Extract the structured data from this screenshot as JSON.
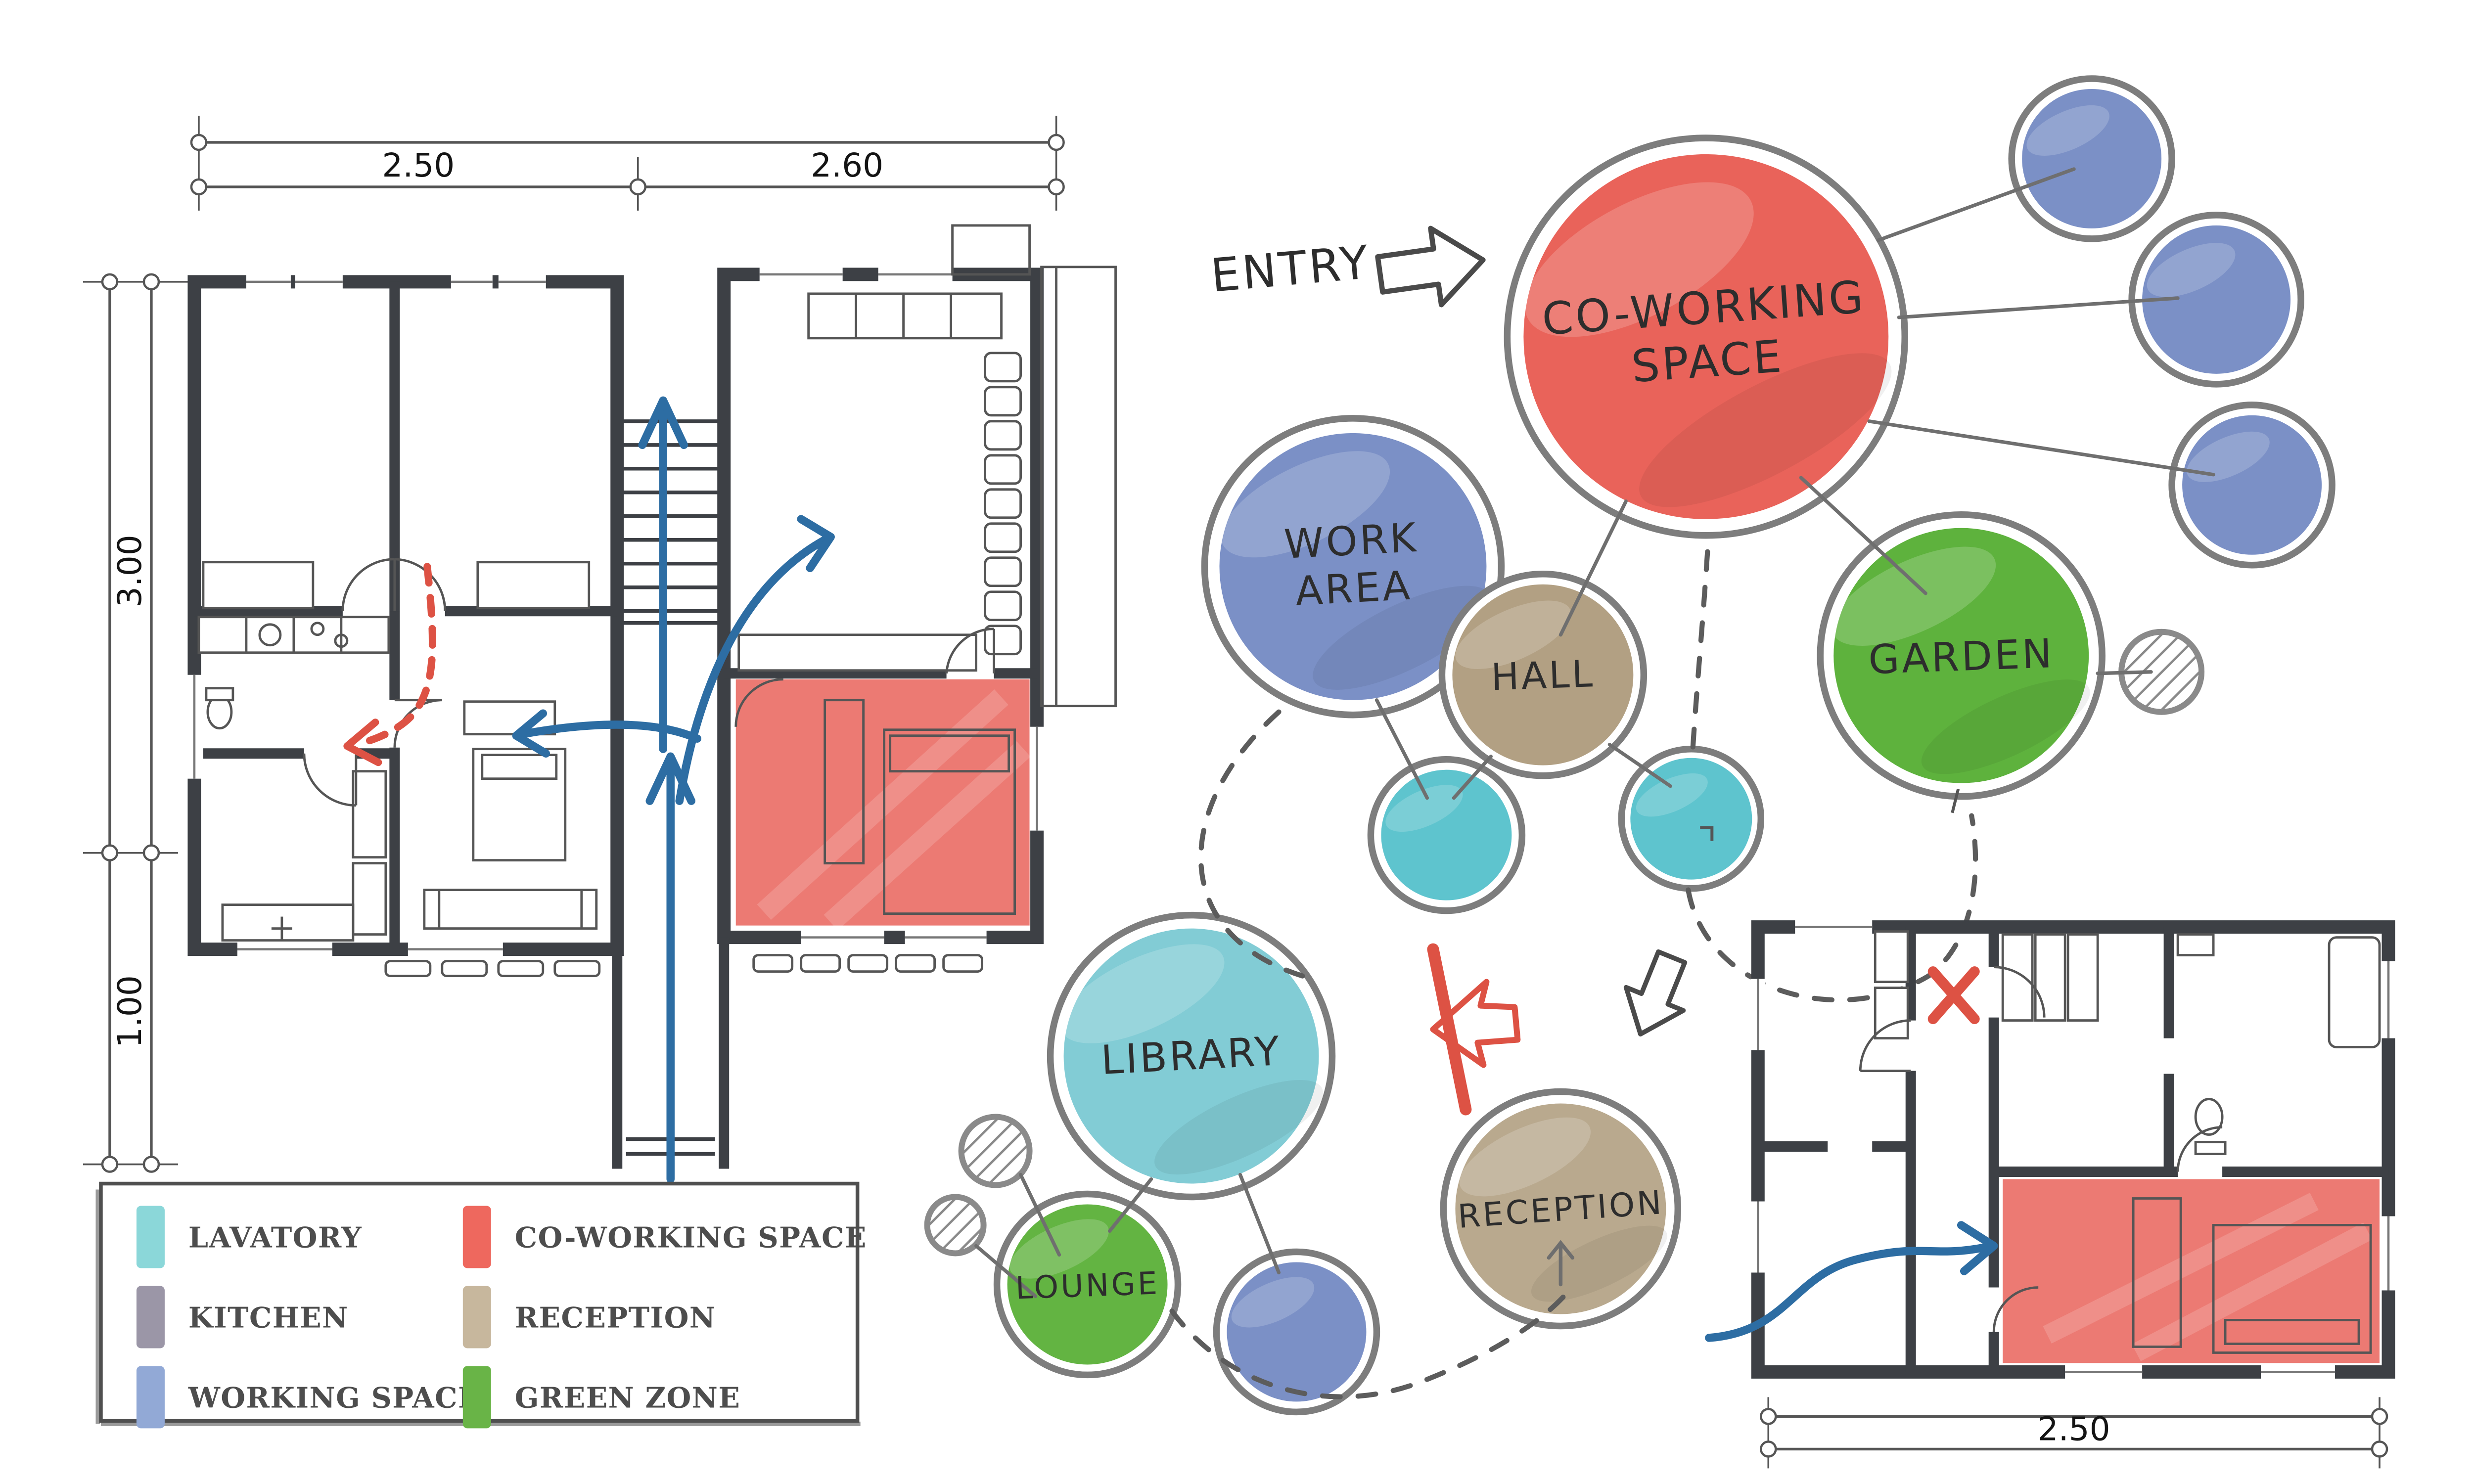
{
  "diagram": {
    "entry_label": "ENTRY",
    "bubbles": {
      "coworking": {
        "label_line1": "CO-WORKING",
        "label_line2": "SPACE",
        "color": "#e9635a"
      },
      "work_area": {
        "label_line1": "WORK",
        "label_line2": "AREA",
        "color": "#7b90c6"
      },
      "hall": {
        "label": "HALL",
        "color": "#b2a083"
      },
      "garden": {
        "label": "GARDEN",
        "color": "#5eb23d"
      },
      "library": {
        "label": "LIBRARY",
        "color": "#82ccd5"
      },
      "lounge": {
        "label": "LOUNGE",
        "color": "#63b442"
      },
      "reception": {
        "label": "RECEPTION",
        "color": "#b9a98e"
      }
    },
    "palette": {
      "working_space": "#7b90c6",
      "lavatory": "#5ec4ce"
    }
  },
  "plans": {
    "highlight_color": "#e9635a",
    "main": {
      "dim_top_left": "2.50",
      "dim_top_right": "2.60",
      "dim_side_upper": "3.00",
      "dim_side_lower": "1.00"
    },
    "small": {
      "dim_bottom": "2.50"
    }
  },
  "legend": {
    "items": [
      {
        "label": "LAVATORY",
        "color": "#8bd7d9"
      },
      {
        "label": "KITCHEN",
        "color": "#9b96a7"
      },
      {
        "label": "WORKING SPACE",
        "color": "#92a9d6"
      },
      {
        "label": "CO-WORKING SPACE",
        "color": "#ee685e"
      },
      {
        "label": "RECEPTION",
        "color": "#c7b79d"
      },
      {
        "label": "GREEN ZONE",
        "color": "#69b447"
      }
    ]
  }
}
